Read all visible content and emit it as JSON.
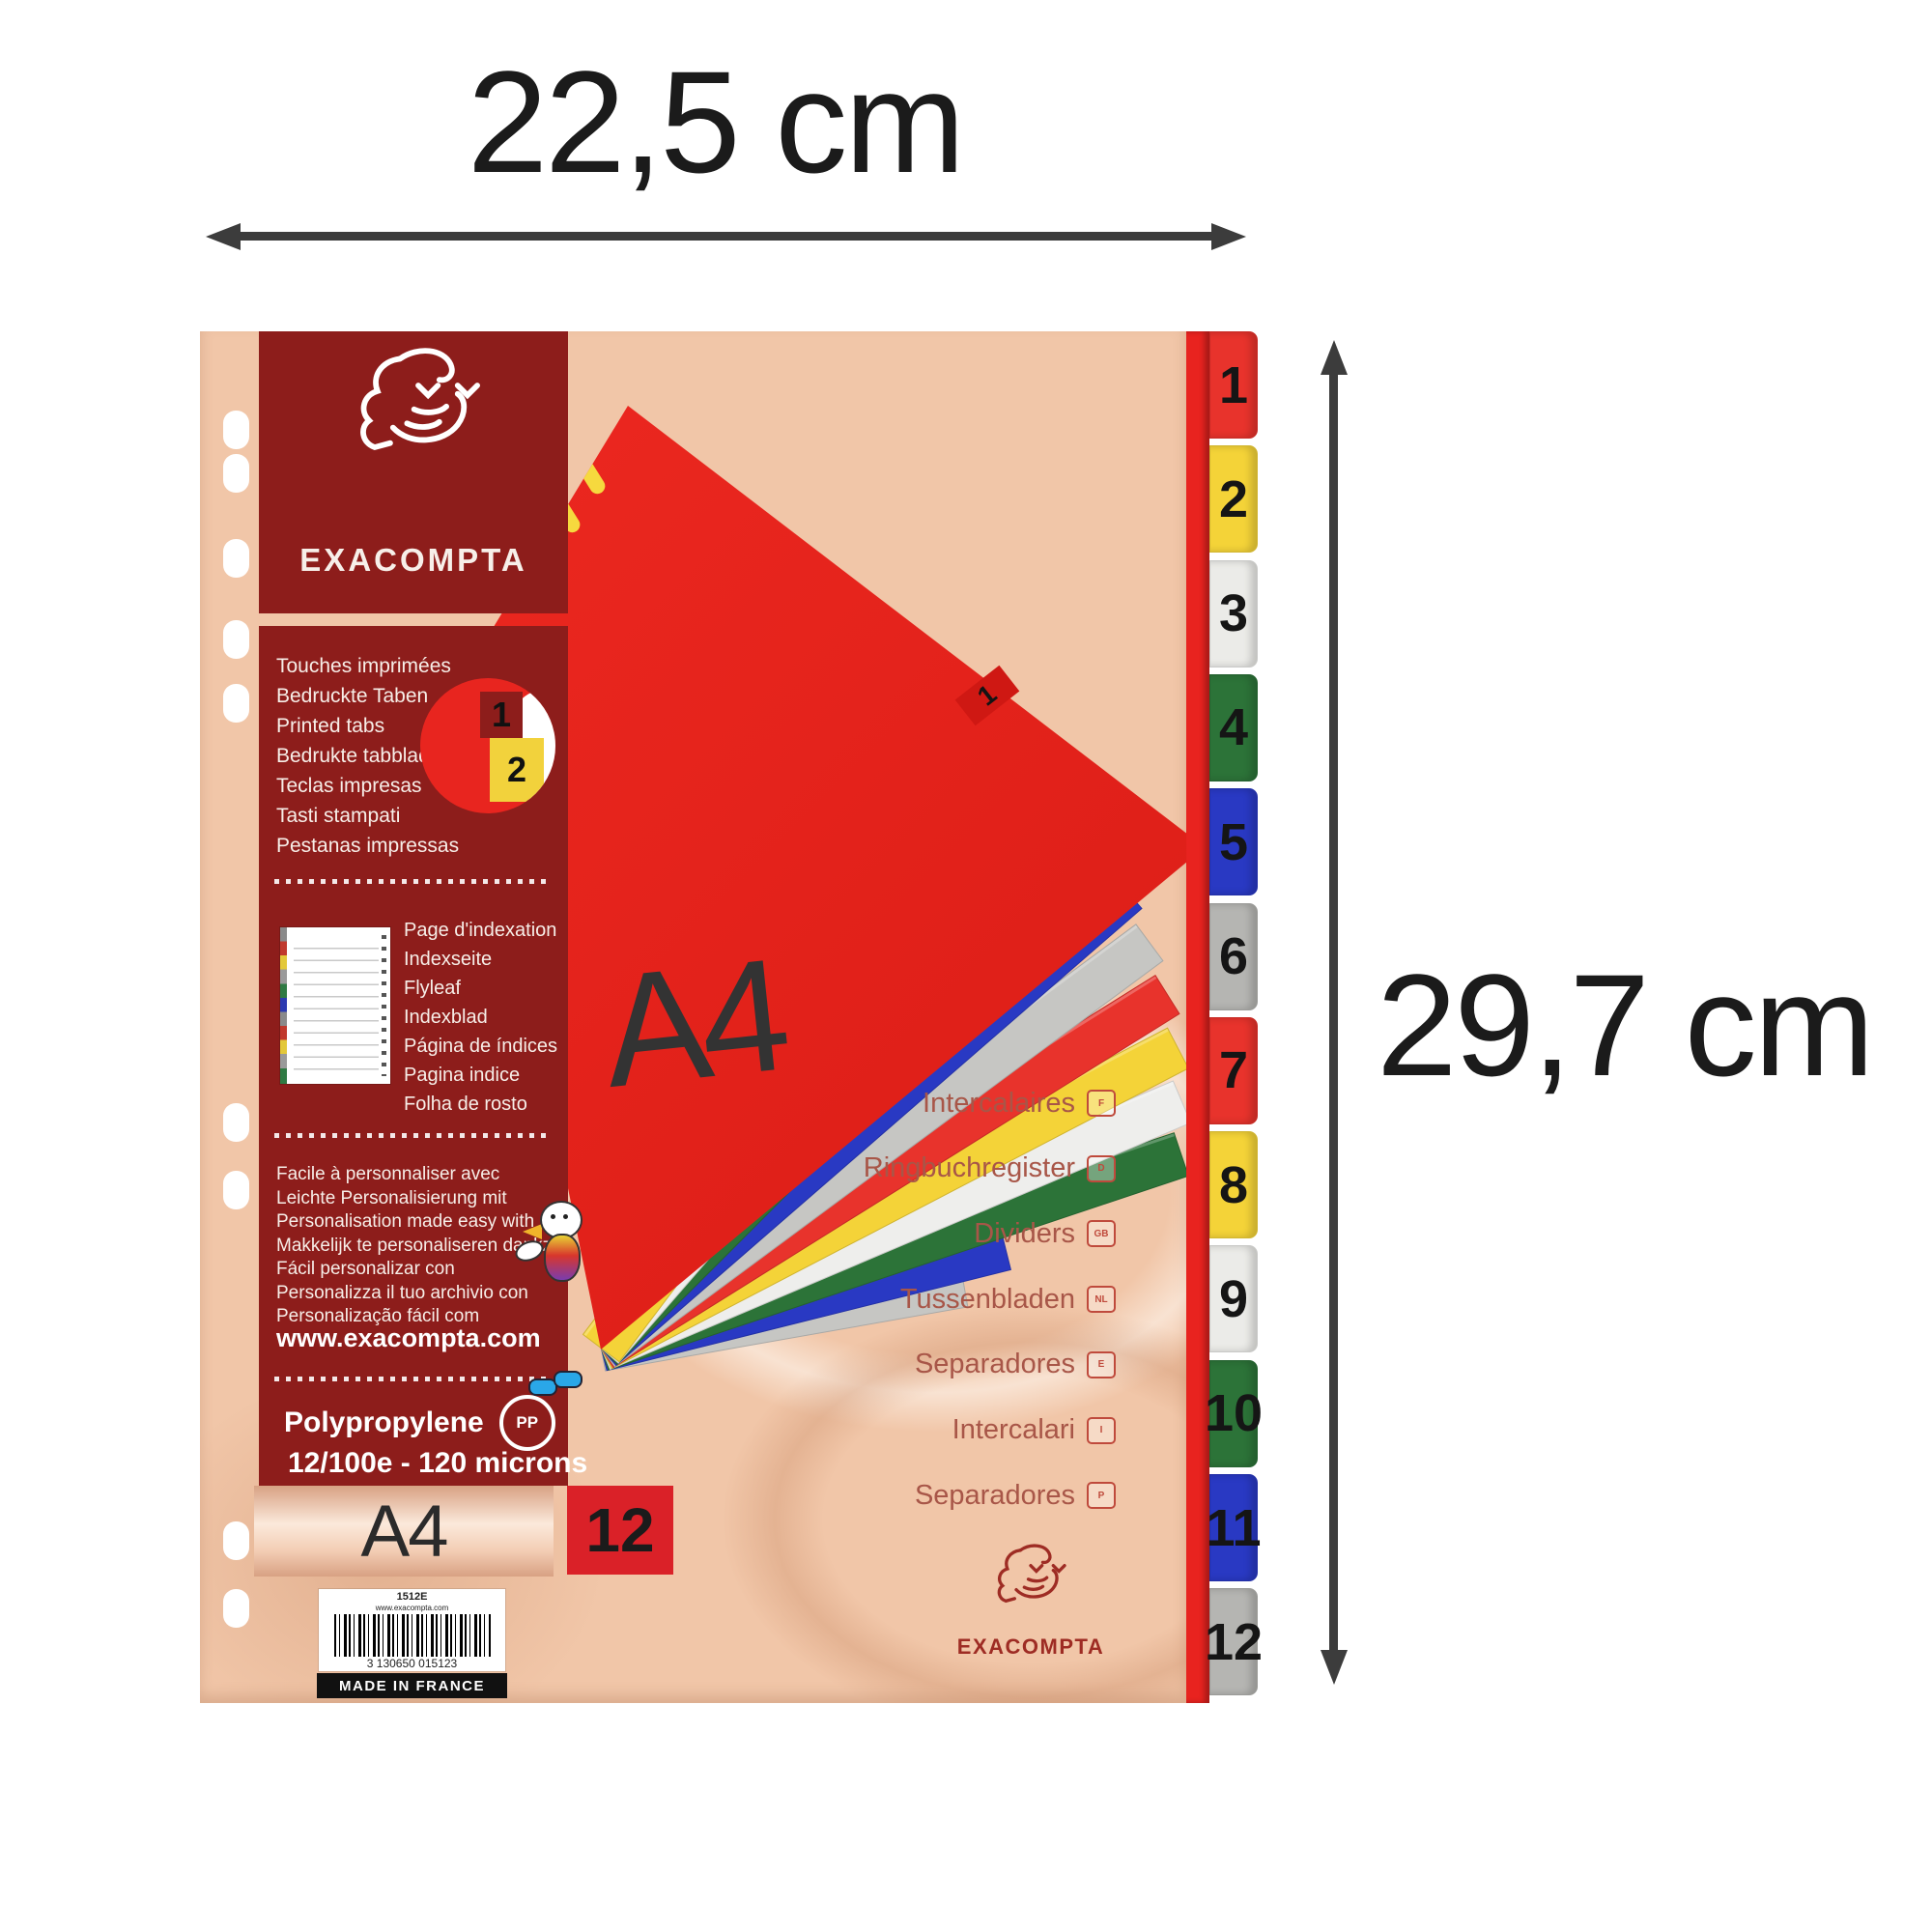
{
  "dimensions": {
    "width_label": "22,5 cm",
    "height_label": "29,7 cm"
  },
  "brand": {
    "name": "EXACOMPTA"
  },
  "cover": {
    "format_label": "A4",
    "tab_label": "1"
  },
  "panel": {
    "printed_tabs_lines": [
      "Touches imprimées",
      "Bedruckte Taben",
      "Printed tabs",
      "Bedrukte tabbladen",
      "Teclas impresas",
      "Tasti stampati",
      "Pestanas impressas"
    ],
    "sample_tabs": {
      "first": "1",
      "second": "2"
    },
    "index_page_lines": [
      "Page d'indexation",
      "Indexseite",
      "Flyleaf",
      "Indexblad",
      "Página de índices",
      "Pagina indice",
      "Folha de rosto"
    ],
    "personalize_lines": [
      "Facile à personnaliser avec",
      "Leichte Personalisierung mit",
      "Personalisation made easy with",
      "Makkelijk te personaliseren dankzij",
      "Fácil personalizar con",
      "Personalizza il tuo archivio con",
      "Personalização fácil com"
    ],
    "website": "www.exacompta.com",
    "material": "Polypropylene",
    "material_icon": "PP",
    "thickness": "12/100e - 120 microns",
    "format_label": "A4",
    "tab_count": "12"
  },
  "languages": [
    {
      "label": "Intercalaires",
      "code": "F"
    },
    {
      "label": "Ringbuchregister",
      "code": "D"
    },
    {
      "label": "Dividers",
      "code": "GB"
    },
    {
      "label": "Tussenbladen",
      "code": "NL"
    },
    {
      "label": "Separadores",
      "code": "E"
    },
    {
      "label": "Intercalari",
      "code": "I"
    },
    {
      "label": "Separadores",
      "code": "P"
    }
  ],
  "barcode": {
    "ref": "1512E",
    "url": "www.exacompta.com",
    "ean": "3 130650 015123",
    "origin": "MADE IN FRANCE"
  },
  "edge_tabs": [
    {
      "label": "1",
      "color": "#e8332c"
    },
    {
      "label": "2",
      "color": "#f4d338"
    },
    {
      "label": "3",
      "color": "#ebebe8"
    },
    {
      "label": "4",
      "color": "#2c7338"
    },
    {
      "label": "5",
      "color": "#2939c3"
    },
    {
      "label": "6",
      "color": "#b5b5b2"
    },
    {
      "label": "7",
      "color": "#e8332c"
    },
    {
      "label": "8",
      "color": "#f4d338"
    },
    {
      "label": "9",
      "color": "#ebebe8"
    },
    {
      "label": "10",
      "color": "#2c7338"
    },
    {
      "label": "11",
      "color": "#2939c3"
    },
    {
      "label": "12",
      "color": "#b5b5b2"
    }
  ],
  "fan_sheets": [
    {
      "label": "2",
      "color": "#f4d338"
    },
    {
      "label": "3",
      "color": "#eeeeec"
    },
    {
      "label": "4",
      "color": "#2c7338"
    },
    {
      "label": "5",
      "color": "#2939c3"
    },
    {
      "label": "6",
      "color": "#c6c6c3"
    },
    {
      "label": "7",
      "color": "#e8332c"
    },
    {
      "label": "8",
      "color": "#f4d338"
    },
    {
      "label": "9",
      "color": "#eeeeec"
    },
    {
      "label": "10",
      "color": "#2c7338"
    },
    {
      "label": "",
      "color": "#2939c3"
    },
    {
      "label": "",
      "color": "#c6c6c3"
    }
  ],
  "colors": {
    "background": "#ffffff",
    "sheet_peach": "#f1c6a8",
    "panel_maroon": "#8d1d1b",
    "cover_red": "#e8231f",
    "count_box_red": "#da2128",
    "annotation_dark": "#3c3c3c",
    "language_text": "#a85648",
    "logo_red": "#9e2c24"
  }
}
